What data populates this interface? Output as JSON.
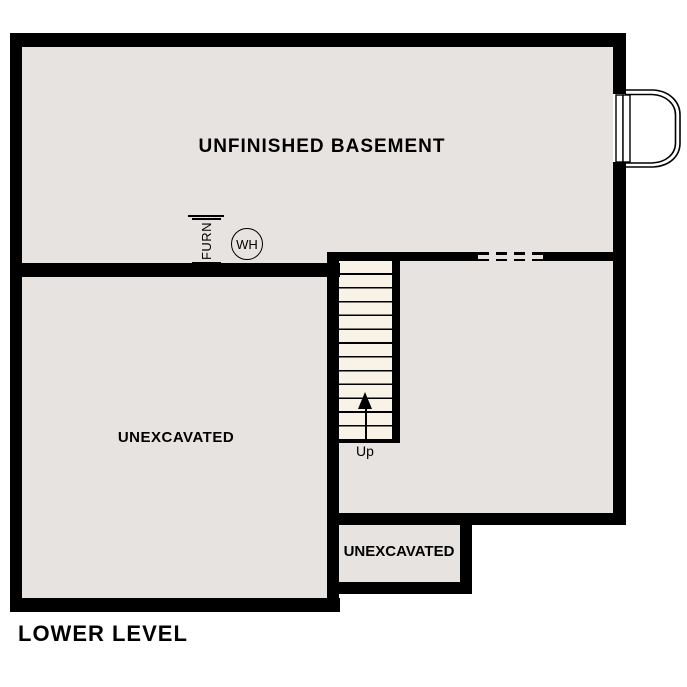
{
  "plan": {
    "level_label": "LOWER LEVEL",
    "rooms": [
      {
        "name": "unfinished-basement",
        "label": "UNFINISHED BASEMENT"
      },
      {
        "name": "unexcavated-left",
        "label": "UNEXCAVATED"
      },
      {
        "name": "basement-right",
        "label": ""
      },
      {
        "name": "unexcavated-small",
        "label": "UNEXCAVATED"
      }
    ],
    "stairs": {
      "label": "Up",
      "direction": "up",
      "treads": 13
    },
    "fixtures": {
      "furnace_label": "FURN",
      "water_heater_label": "WH"
    },
    "colors": {
      "wall": "#000000",
      "floor": "#e6e3e1",
      "stair_fill": "#f9f2e6",
      "background": "#ffffff"
    }
  }
}
